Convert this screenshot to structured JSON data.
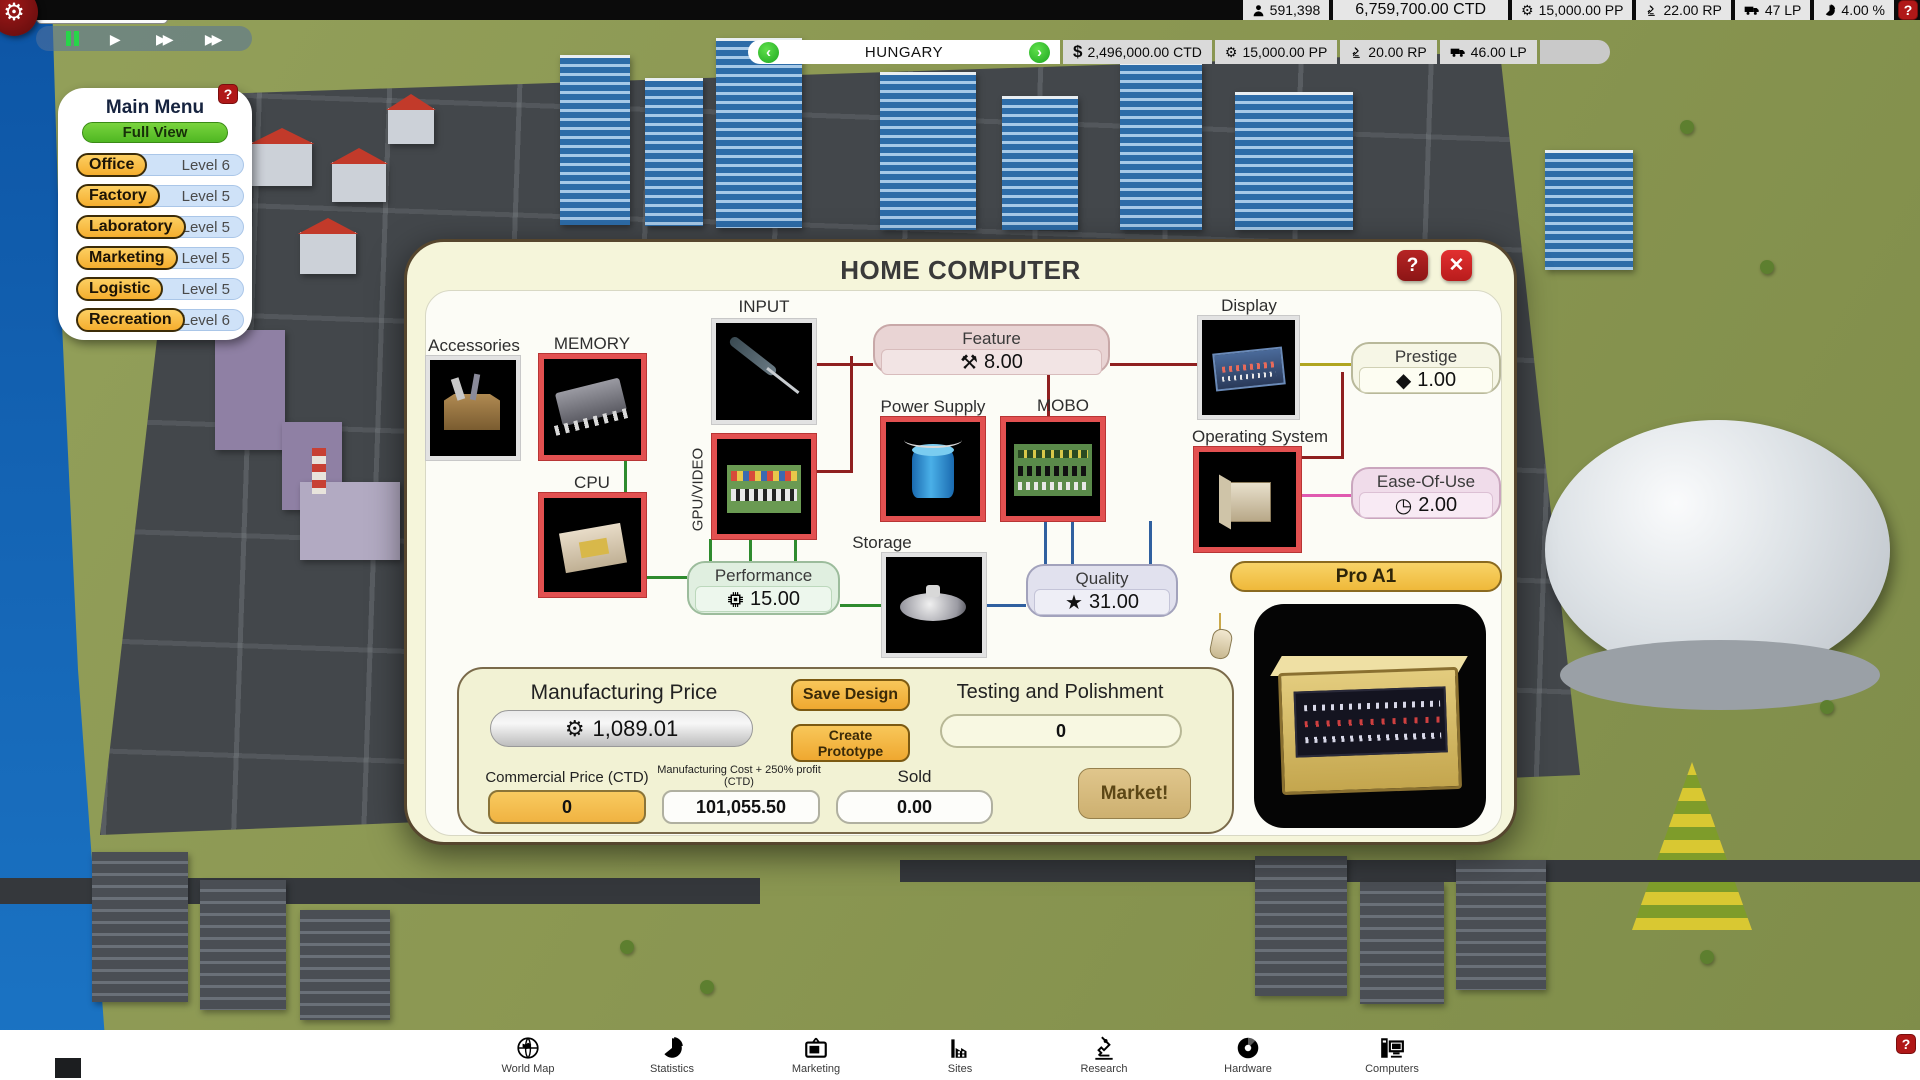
{
  "icons": {
    "gear": "⚙",
    "star": "★",
    "diamond": "◆",
    "clock": "◷",
    "tools": "⚒",
    "play": "▶",
    "fast_forward": "▶▶",
    "question": "?",
    "close": "✕",
    "arrow_left": "‹",
    "arrow_right": "›",
    "dollar": "$"
  },
  "colors": {
    "accent_orange": "#f5ae2e",
    "accent_green": "#4fb722",
    "frame_red": "#e25050",
    "dialog_cream": "#f5f5da",
    "line_red": "#8f1f1f",
    "line_green": "#2e8b2e",
    "line_blue": "#3060a0",
    "line_pink": "#e05ab0",
    "line_olive": "#b0a520"
  },
  "top_bar": {
    "date": "9/7/1974",
    "population": "591,398",
    "money": "6,759,700.00 CTD",
    "pp": "15,000.00 PP",
    "rp": "22.00 RP",
    "lp": "47 LP",
    "percent": "4.00 %",
    "help": "?"
  },
  "country_bar": {
    "name": "HUNGARY",
    "money": "2,496,000.00 CTD",
    "pp": "15,000.00 PP",
    "rp": "20.00 RP",
    "lp": "46.00 LP"
  },
  "main_menu": {
    "title": "Main Menu",
    "help": "?",
    "full_view": "Full View",
    "items": [
      {
        "label": "Office",
        "level": "Level 6"
      },
      {
        "label": "Factory",
        "level": "Level 5"
      },
      {
        "label": "Laboratory",
        "level": "Level 5"
      },
      {
        "label": "Marketing",
        "level": "Level 5"
      },
      {
        "label": "Logistic",
        "level": "Level 5"
      },
      {
        "label": "Recreation",
        "level": "Level 6"
      }
    ]
  },
  "dialog": {
    "title": "HOME COMPUTER",
    "help": "?",
    "close": "✕",
    "components": {
      "accessories": "Accessories",
      "memory": "MEMORY",
      "input": "INPUT",
      "gpu": "GPU/VIDEO",
      "cpu": "CPU",
      "power_supply": "Power Supply",
      "mobo": "MOBO",
      "storage": "Storage",
      "display": "Display",
      "os": "Operating System"
    },
    "stats": {
      "feature": {
        "label": "Feature",
        "value": "8.00"
      },
      "prestige": {
        "label": "Prestige",
        "value": "1.00"
      },
      "ease": {
        "label": "Ease-Of-Use",
        "value": "2.00"
      },
      "performance": {
        "label": "Performance",
        "value": "15.00"
      },
      "quality": {
        "label": "Quality",
        "value": "31.00"
      }
    },
    "product_name": "Pro A1",
    "manufacturing": {
      "price_label": "Manufacturing Price",
      "price_value": "1,089.01",
      "save_design": "Save Design",
      "create_prototype": "Create Prototype",
      "testing_label": "Testing and Polishment",
      "testing_value": "0",
      "commercial_label": "Commercial Price (CTD)",
      "commercial_value": "0",
      "cost_label_1": "Manufacturing Cost + 250% profit",
      "cost_label_2": "(CTD)",
      "cost_value": "101,055.50",
      "sold_label": "Sold",
      "sold_value": "0.00",
      "market": "Market!"
    }
  },
  "toolbar": {
    "items": [
      {
        "label": "World Map"
      },
      {
        "label": "Statistics"
      },
      {
        "label": "Marketing"
      },
      {
        "label": "Sites"
      },
      {
        "label": "Research"
      },
      {
        "label": "Hardware"
      },
      {
        "label": "Computers"
      }
    ]
  }
}
